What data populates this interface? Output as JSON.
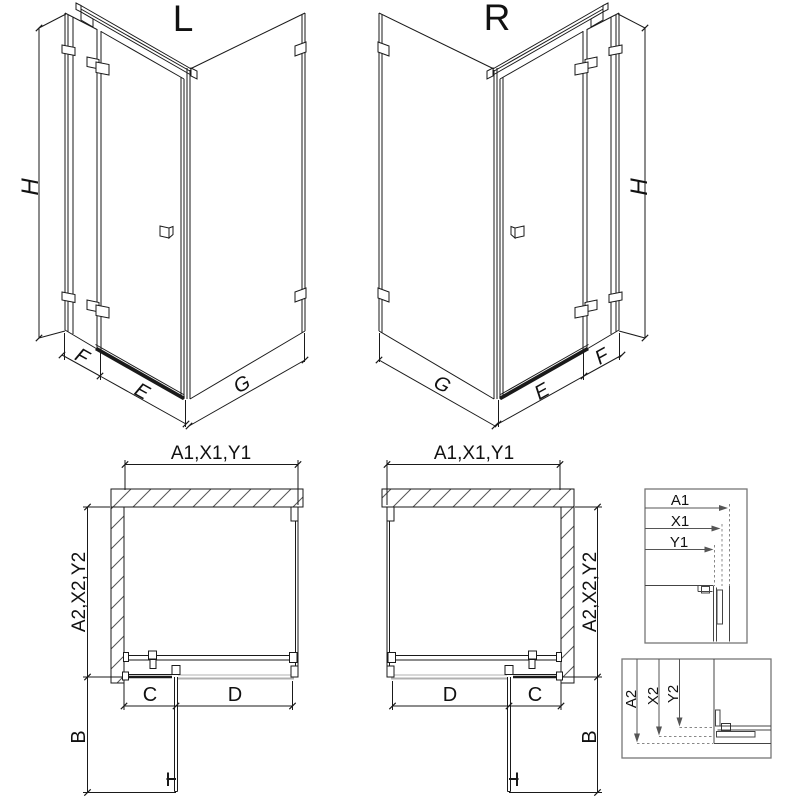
{
  "views": {
    "left": {
      "label": "L"
    },
    "right": {
      "label": "R"
    }
  },
  "dimensions": {
    "height": "H",
    "fixed_front": "F",
    "door_front": "E",
    "side_wall": "G",
    "width_group": "A1,X1,Y1",
    "depth_group": "A2,X2,Y2",
    "door_open_clearance": "B",
    "fixed_segment": "C",
    "door_width": "D"
  },
  "detail_legend": {
    "a1": "A1",
    "x1": "X1",
    "y1": "Y1",
    "a2": "A2",
    "x2": "X2",
    "y2": "Y2"
  },
  "colors": {
    "line": "#1a1a1a",
    "ghost": "#b0b0b0",
    "hatch": "#555555",
    "detail": "#444444",
    "box_border": "#777777"
  }
}
